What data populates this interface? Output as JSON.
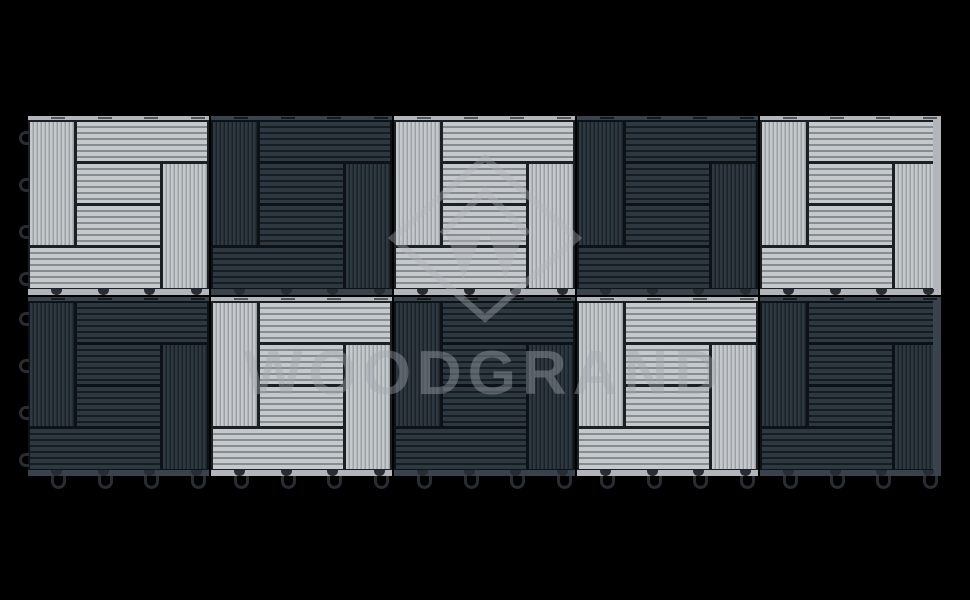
{
  "scene": {
    "background": "#000000",
    "subject": "interlocking composite deck tiles, checkerboard of light gray and charcoal pinwheel-pattern tiles"
  },
  "watermark": {
    "text": "WOODGRAND",
    "text_color": "rgba(160,168,173,0.42)",
    "logo_color": "rgba(175,182,187,0.38)"
  },
  "grid": {
    "left": 28,
    "top": 116,
    "cols": 5,
    "rows_count": 2,
    "tile_width": 181,
    "tile_height": 179,
    "gap": 2,
    "rows": [
      [
        "light",
        "dark",
        "light",
        "dark",
        "light"
      ],
      [
        "dark",
        "light",
        "dark",
        "light",
        "dark"
      ]
    ]
  },
  "tile_pattern": {
    "sections": [
      {
        "name": "left-vertical-slats",
        "x": 0,
        "y": 0,
        "w": 0.26,
        "h": 0.75,
        "dir": "v"
      },
      {
        "name": "top-horizontal-slats",
        "x": 0.26,
        "y": 0,
        "w": 0.74,
        "h": 0.25,
        "dir": "h"
      },
      {
        "name": "middle-upper-horizontal-slats",
        "x": 0.26,
        "y": 0.25,
        "w": 0.48,
        "h": 0.25,
        "dir": "h"
      },
      {
        "name": "middle-lower-horizontal-slats",
        "x": 0.26,
        "y": 0.5,
        "w": 0.48,
        "h": 0.25,
        "dir": "h"
      },
      {
        "name": "right-vertical-slats",
        "x": 0.74,
        "y": 0.25,
        "w": 0.26,
        "h": 0.75,
        "dir": "v"
      },
      {
        "name": "bottom-horizontal-slats",
        "x": 0,
        "y": 0.75,
        "w": 0.74,
        "h": 0.25,
        "dir": "h"
      }
    ]
  },
  "palette": {
    "light": {
      "slat": "#c6c9cc",
      "groove": "#868d92",
      "vgroove": "#9aa1a6",
      "divider": "#1b2024",
      "edge": "#b2b6ba",
      "edge_mark": "#53585c"
    },
    "dark": {
      "slat": "#2e3840",
      "groove": "#151c22",
      "vgroove": "#1a2127",
      "divider": "#0d1216",
      "edge": "#3a434b",
      "edge_mark": "#151a1e"
    },
    "connector": "#272d32"
  },
  "connectors": {
    "edge_offsets": [
      23,
      70,
      116,
      163
    ],
    "side_offsets": [
      15,
      62,
      109,
      156
    ]
  }
}
